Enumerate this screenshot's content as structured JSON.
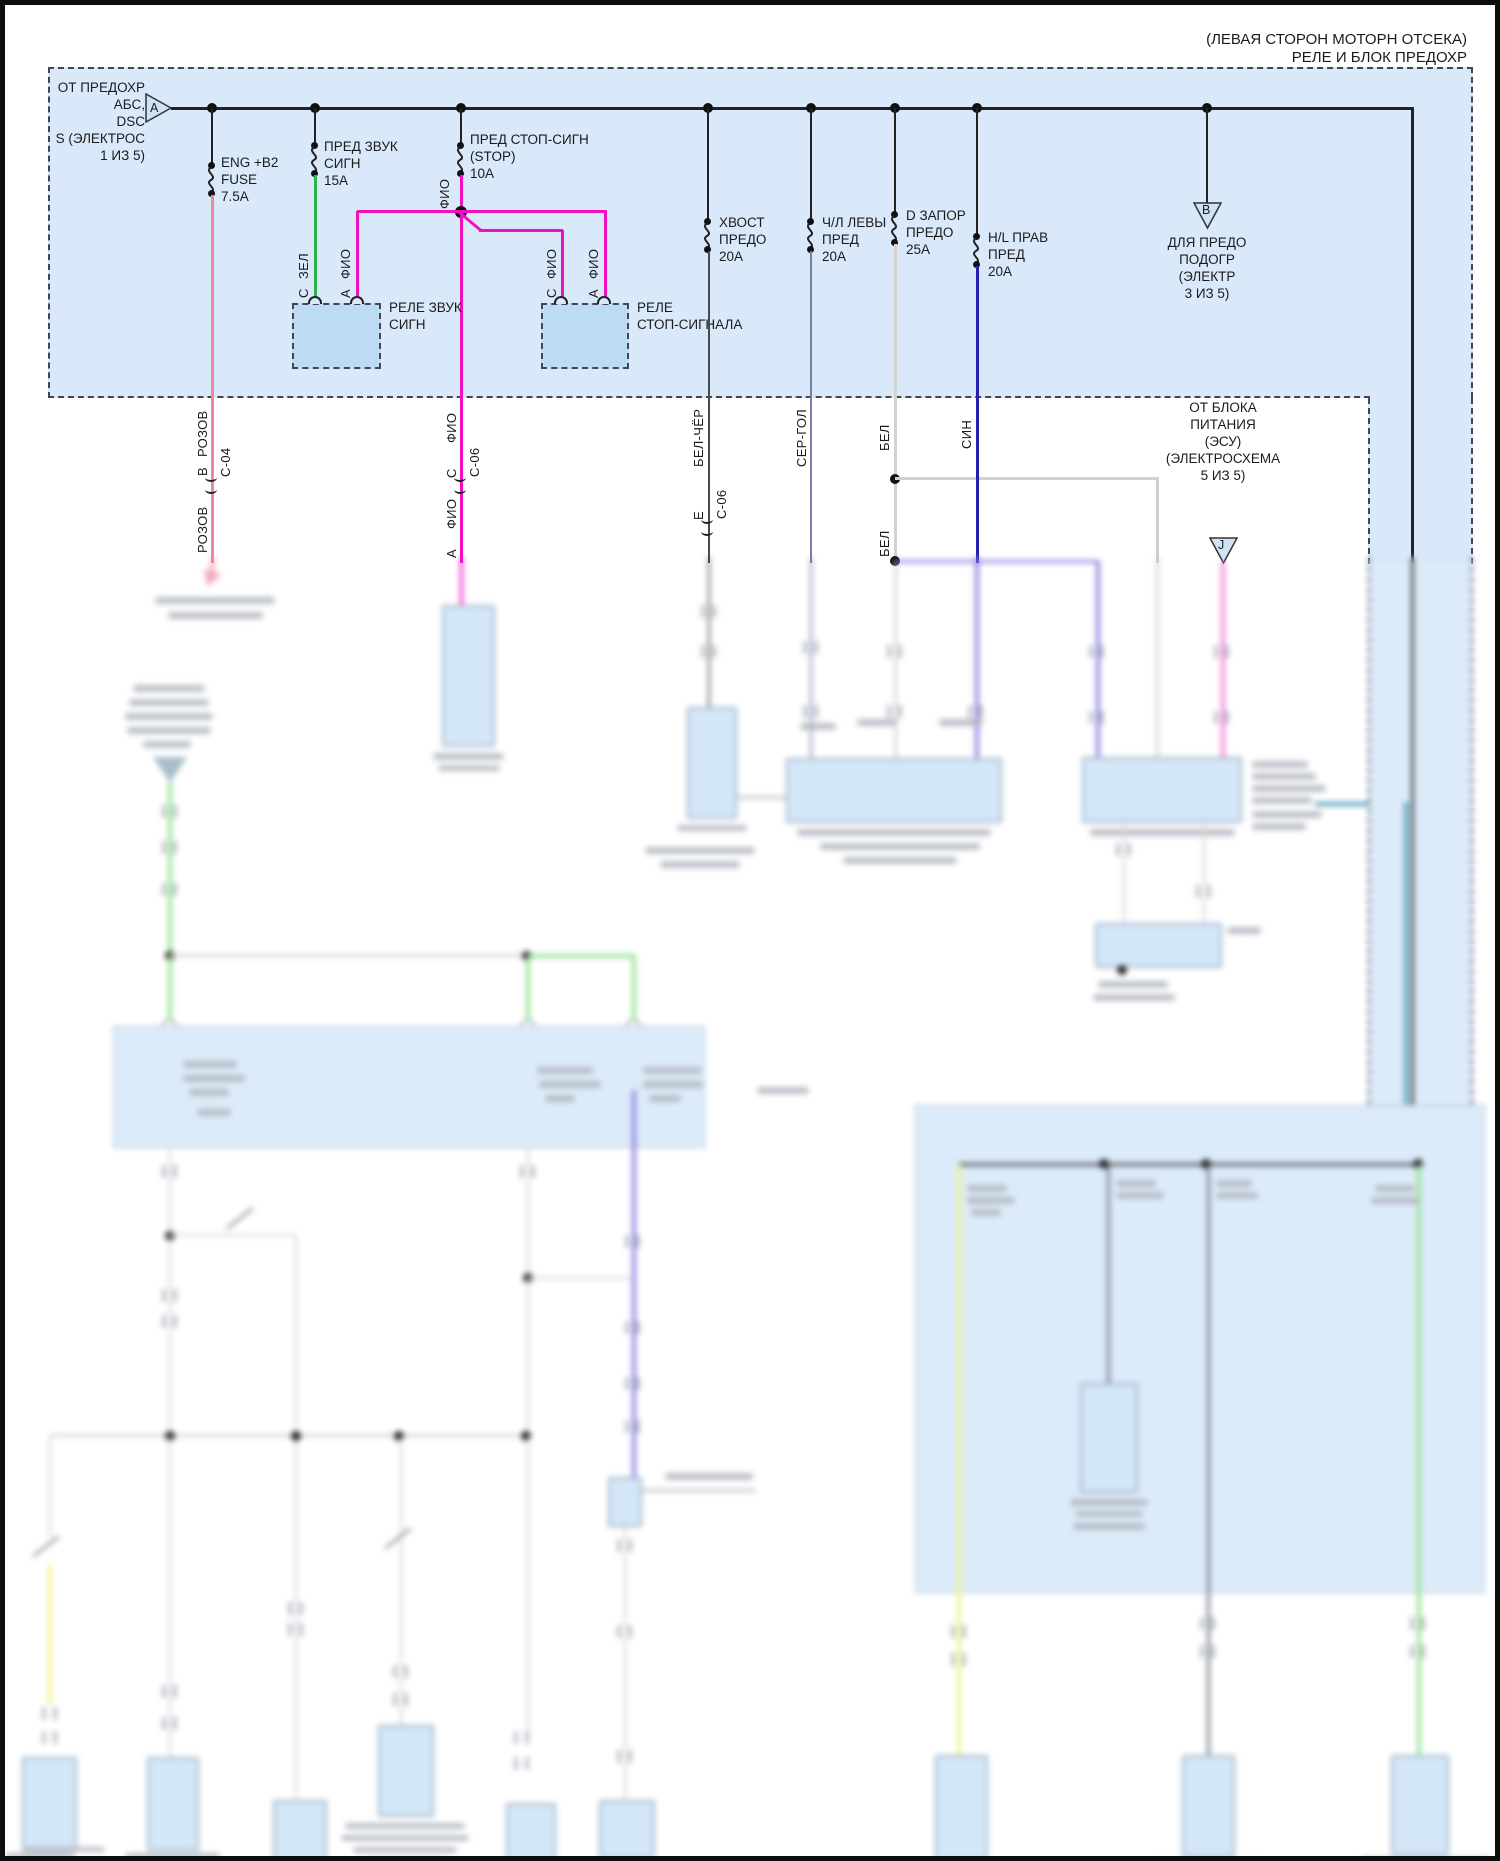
{
  "title": {
    "line1": "(ЛЕВАЯ СТОРОН МОТОРН ОТСЕКА)",
    "line2": "РЕЛЕ И БЛОК ПРЕДОХР"
  },
  "source_a": {
    "letter": "A",
    "lines": [
      "ОТ ПРЕДОХР",
      "АБС,",
      "DSC",
      "S (ЭЛЕКТРОС",
      "1 ИЗ 5)"
    ]
  },
  "dest_b": {
    "letter": "B",
    "lines": [
      "ДЛЯ ПРЕДО",
      "ПОДОГР",
      "(ЭЛЕКТР",
      "3 ИЗ 5)"
    ]
  },
  "source_j": {
    "letter": "J",
    "lines": [
      "ОТ БЛОКА",
      "ПИТАНИЯ",
      "(ЭСУ)",
      "(ЭЛЕКТРОСХЕМА",
      "5 ИЗ 5)"
    ]
  },
  "fuses": [
    {
      "name": "eng-b2-fuse",
      "lines": [
        "ENG +B2",
        "FUSE",
        "7.5A"
      ]
    },
    {
      "name": "horn-fuse",
      "lines": [
        "ПРЕД ЗВУК",
        "СИГН",
        "15А"
      ]
    },
    {
      "name": "stop-fuse",
      "lines": [
        "ПРЕД СТОП-СИГН",
        "(STOP)",
        "10A"
      ]
    },
    {
      "name": "tail-fuse",
      "lines": [
        "ХВОСТ",
        "ПРЕДО",
        "20А"
      ]
    },
    {
      "name": "left-fuse",
      "lines": [
        "Ч/Л ЛЕВЫ",
        "ПРЕД",
        "20А"
      ]
    },
    {
      "name": "door-lock-fuse",
      "lines": [
        "D ЗАПОР",
        "ПРЕДО",
        "25А"
      ]
    },
    {
      "name": "hl-right-fuse",
      "lines": [
        "H/L ПРАВ",
        "ПРЕД",
        "20А"
      ]
    }
  ],
  "relays": [
    {
      "label": [
        "РЕЛЕ ЗВУК",
        "СИГН"
      ],
      "pins": [
        {
          "letter": "C",
          "wire": "ЗЕЛ"
        },
        {
          "letter": "А",
          "wire": "ФИО"
        }
      ]
    },
    {
      "label": [
        "РЕЛЕ",
        "СТОП-СИГНАЛА"
      ],
      "pins": [
        {
          "letter": "С",
          "wire": "ФИО"
        },
        {
          "letter": "А",
          "wire": "ФИО"
        }
      ]
    }
  ],
  "wire_labels": {
    "fio_fuse": "ФИО",
    "rozov_top": "РОЗОВ",
    "rozov_pin": "B",
    "rozov_conn": "C-04",
    "rozov_bottom": "РОЗОВ",
    "fio_top": "ФИО",
    "fio_pin": "C",
    "fio_conn": "C-06",
    "fio_bottom": "ФИО",
    "fio_pin_bottom": "А",
    "belcher": "БЕЛ-ЧЁР",
    "belcher_pin": "Е",
    "belcher_conn": "C-06",
    "sergol": "СЕР-ГОЛ",
    "bel_top": "БЕЛ",
    "bel_bottom": "БЕЛ",
    "sin": "СИН"
  },
  "colors": {
    "rozov": "#f087a0",
    "zel": "#2eb34a",
    "fio": "#f10fc6",
    "sin": "#2320ad",
    "bel": "#d2d2d2",
    "bel_cher": "#4a4a4a",
    "ser_gol": "#767fa6",
    "purple": "#8278dd",
    "pink_j": "#f07fd6",
    "teal": "#4596b8",
    "yellow": "#eef283",
    "green_light": "#8ce08a",
    "box_fill": "#d9e9f9",
    "relay_fill": "#bddcf4"
  }
}
